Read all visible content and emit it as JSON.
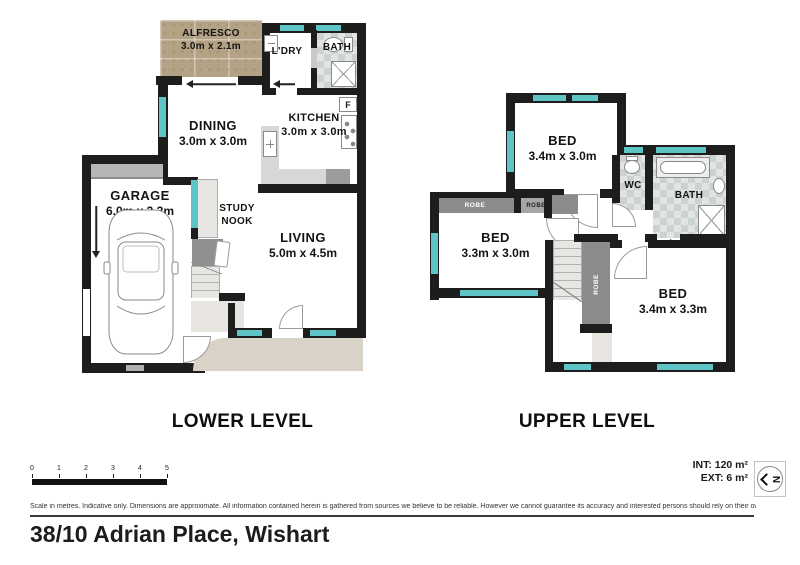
{
  "address": "38/10 Adrian Place, Wishart",
  "areas": {
    "int": "INT: 120 m²",
    "ext": "EXT: 6 m²"
  },
  "compass": {
    "letter": "N"
  },
  "scale_bar": {
    "ticks": [
      "0",
      "1",
      "2",
      "3",
      "4",
      "5"
    ]
  },
  "disclaimer": "Scale in metres. Indicative only. Dimensions are approximate. All information contained herein is gathered from sources we believe to be reliable. However we cannot guarantee its accuracy and interested persons should rely on their own enquiries.",
  "levels": {
    "lower": {
      "title": "LOWER LEVEL",
      "alfresco": {
        "name": "ALFRESCO",
        "dims": "3.0m x 2.1m"
      },
      "laundry": {
        "name": "L'DRY"
      },
      "bath": {
        "name": "BATH"
      },
      "dining": {
        "name": "DINING",
        "dims": "3.0m x 3.0m"
      },
      "kitchen": {
        "name": "KITCHEN",
        "dims": "3.0m x 3.0m"
      },
      "fridge": "F",
      "garage": {
        "name": "GARAGE",
        "dims": "6.0m x 3.2m"
      },
      "study": {
        "line1": "STUDY",
        "line2": "NOOK"
      },
      "living": {
        "name": "LIVING",
        "dims": "5.0m x 4.5m"
      }
    },
    "upper": {
      "title": "UPPER LEVEL",
      "bed1": {
        "name": "BED",
        "dims": "3.4m x 3.0m"
      },
      "bed2": {
        "name": "BED",
        "dims": "3.3m x 3.0m"
      },
      "bed3": {
        "name": "BED",
        "dims": "3.4m x 3.3m"
      },
      "wc": {
        "name": "WC"
      },
      "bath": {
        "name": "BATH"
      },
      "robe_left": "ROBE",
      "robe_mid": "ROBE",
      "robe_vertical": "ROBE"
    }
  },
  "colors": {
    "wall": "#1d1d1d",
    "window": "#5fc4c6",
    "porch": "#d9d3c7"
  }
}
